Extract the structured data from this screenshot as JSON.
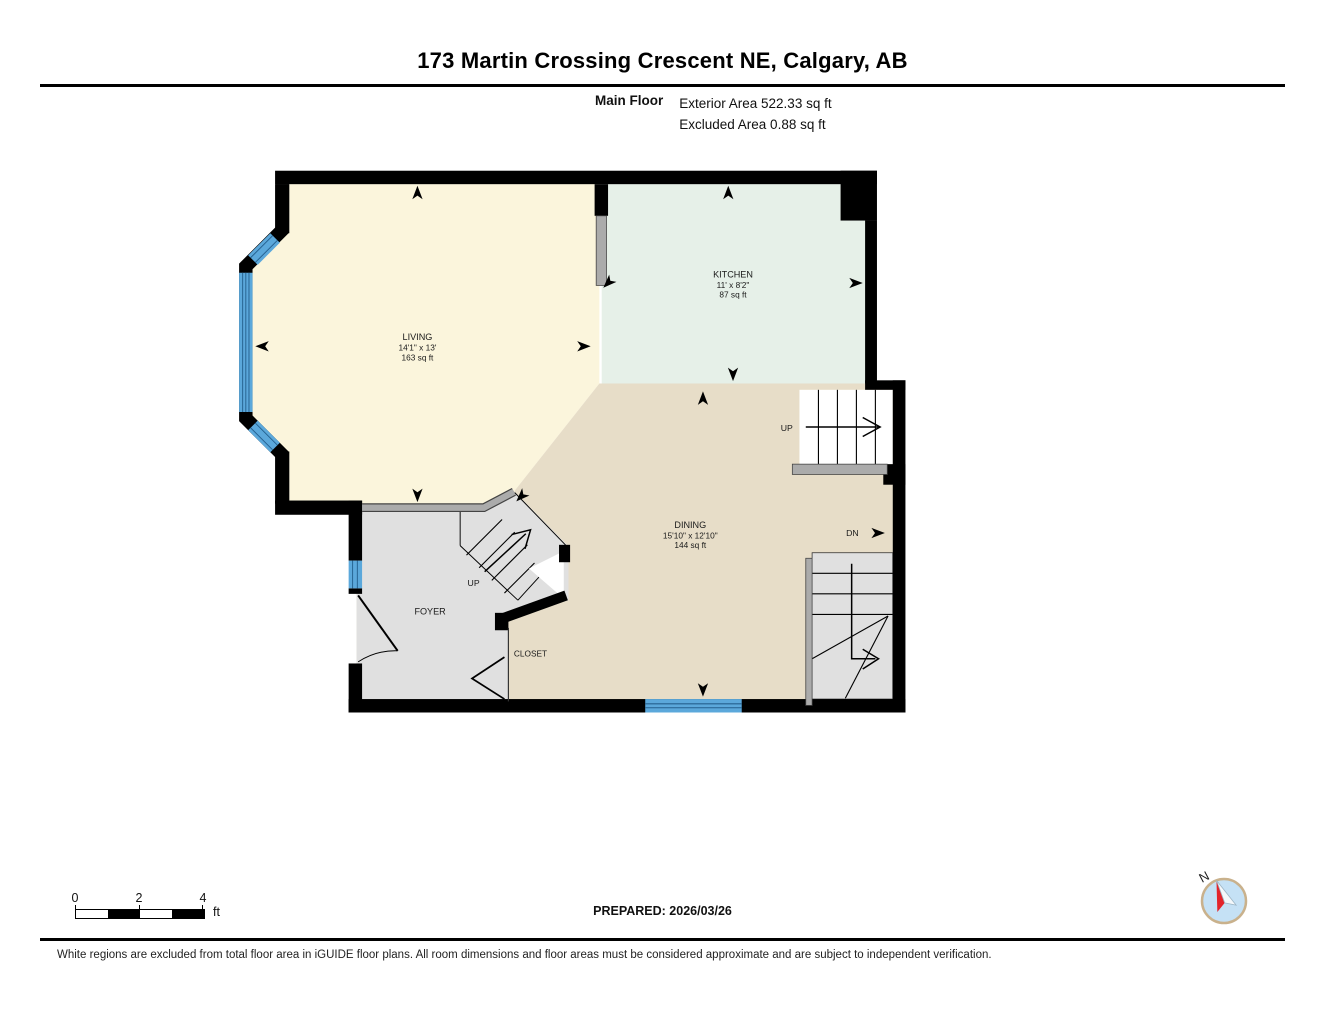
{
  "header": {
    "title": "173 Martin Crossing Crescent NE, Calgary, AB",
    "floor_label": "Main Floor",
    "exterior_area": "Exterior Area 522.33 sq ft",
    "excluded_area": "Excluded Area 0.88 sq ft"
  },
  "plan": {
    "rooms": [
      {
        "id": "living",
        "name": "LIVING",
        "dims": "14'1\" x 13'",
        "area": "163 sq ft",
        "color": "#FBF5DC"
      },
      {
        "id": "kitchen",
        "name": "KITCHEN",
        "dims": "11' x 8'2\"",
        "area": "87 sq ft",
        "color": "#E6F0E8"
      },
      {
        "id": "dining",
        "name": "DINING",
        "dims": "15'10\" x 12'10\"",
        "area": "144 sq ft",
        "color": "#E7DDC8"
      },
      {
        "id": "foyer",
        "name": "FOYER",
        "color": "#E0E0E0"
      },
      {
        "id": "closet",
        "name": "CLOSET",
        "color": "#E7DDC8"
      }
    ],
    "stairs": {
      "up_right": "UP",
      "up_foyer": "UP",
      "down": "DN"
    },
    "colors": {
      "wall": "#000000",
      "window": "#5BA8DB",
      "window_line": "#25618F",
      "half_wall": "#ABABAB",
      "stair_gray": "#E0E0E0",
      "landing_white": "#FFFFFF"
    }
  },
  "footer": {
    "scale": {
      "ticks": [
        "0",
        "2",
        "4"
      ],
      "unit": "ft"
    },
    "prepared": "PREPARED: 2026/03/26",
    "compass_label": "N",
    "compass_colors": {
      "disc": "#C5E1F5",
      "ring": "#C9B18C",
      "needle_north": "#E3242B"
    },
    "disclaimer": "White regions are excluded from total floor area in iGUIDE floor plans. All room dimensions and floor areas must be considered approximate and are subject to independent verification."
  }
}
